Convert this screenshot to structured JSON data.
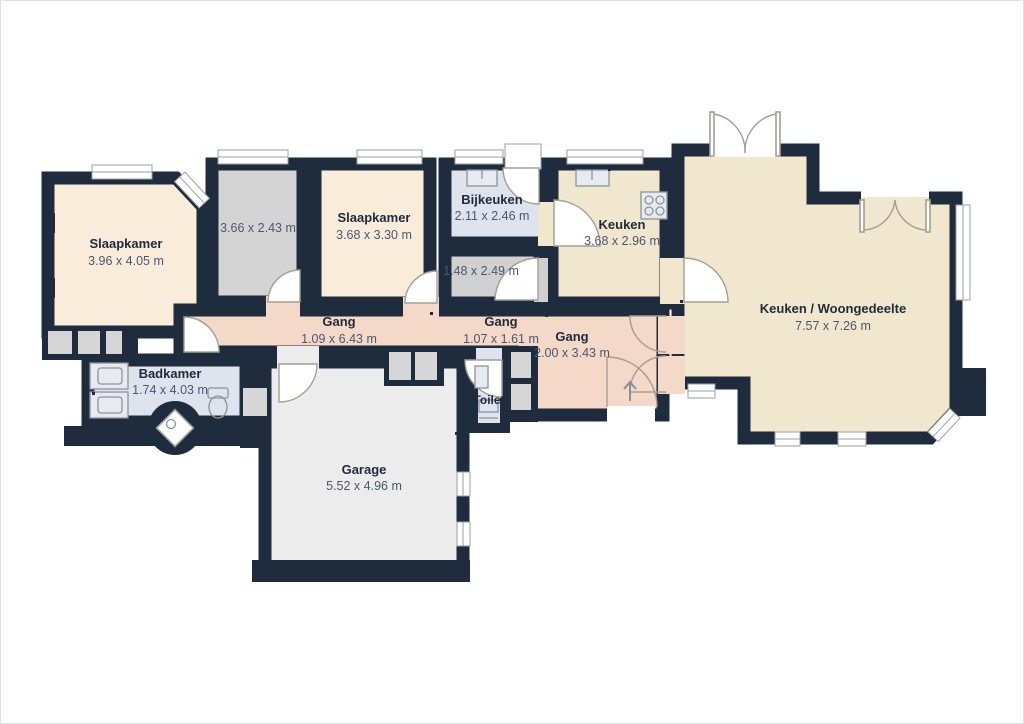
{
  "meta": {
    "type": "floor-plan",
    "language": "nl"
  },
  "palette": {
    "wall": "#1e2c3e",
    "bedroom_fill": "#faecda",
    "living_kitchen_fill": "#f1e6ce",
    "hallway_fill": "#f4d8c8",
    "bathroom_utility_fill": "#dfe3ee",
    "unnamed_room_fill": "#d4d4d4",
    "garage_fill": "#ececec",
    "door_arc": "#a39f94",
    "window_frame": "#9aa0a6",
    "room_name_text": "#1f2a3c",
    "room_dims_text": "#4b5770"
  },
  "rooms": [
    {
      "id": "slaapkamer-1",
      "name": "Slaapkamer",
      "dims": "3.96 x 4.05 m"
    },
    {
      "id": "room-366",
      "name": "",
      "dims": "3.66 x 2.43 m"
    },
    {
      "id": "slaapkamer-2",
      "name": "Slaapkamer",
      "dims": "3.68 x 3.30 m"
    },
    {
      "id": "bijkeuken",
      "name": "Bijkeuken",
      "dims": "2.11 x 2.46 m"
    },
    {
      "id": "room-148",
      "name": "",
      "dims": "1.48 x 2.49 m"
    },
    {
      "id": "keuken",
      "name": "Keuken",
      "dims": "3.68 x 2.96 m"
    },
    {
      "id": "keuken-woongedeelte",
      "name": "Keuken / Woongedeelte",
      "dims": "7.57 x 7.26 m"
    },
    {
      "id": "gang-1",
      "name": "Gang",
      "dims": "1.09 x 6.43 m"
    },
    {
      "id": "gang-2",
      "name": "Gang",
      "dims": "1.07 x 1.61 m"
    },
    {
      "id": "gang-3",
      "name": "Gang",
      "dims": "2.00 x 3.43 m"
    },
    {
      "id": "badkamer",
      "name": "Badkamer",
      "dims": "1.74 x 4.03 m"
    },
    {
      "id": "toilet",
      "name": "Toilet",
      "dims": ""
    },
    {
      "id": "garage",
      "name": "Garage",
      "dims": "5.52 x 4.96 m"
    }
  ]
}
